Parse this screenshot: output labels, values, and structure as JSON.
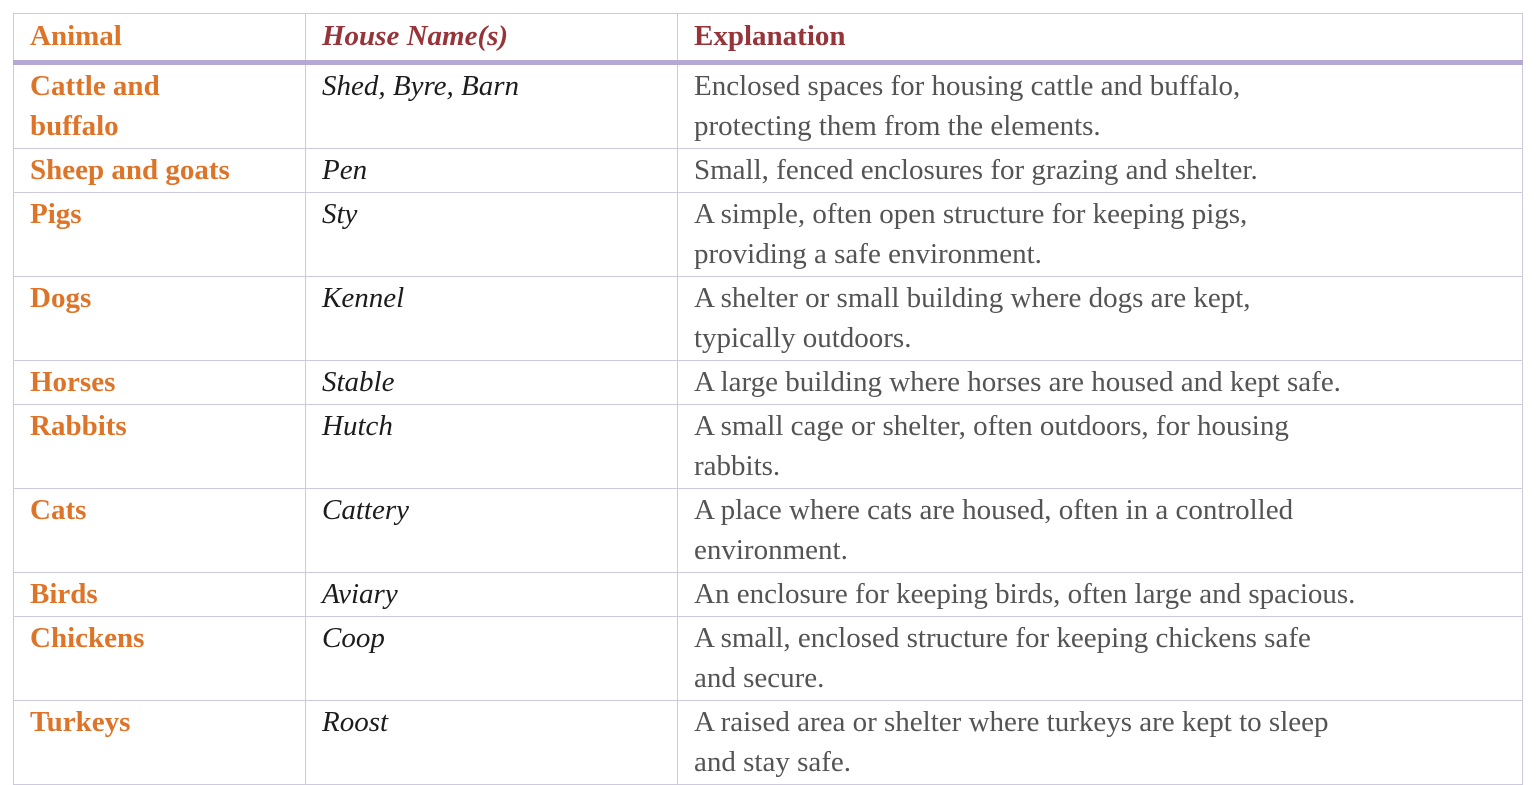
{
  "table": {
    "colors": {
      "animal_text": "#dd7428",
      "header_red": "#97343a",
      "house_text": "#1c1c1c",
      "explanation_text": "#545454",
      "grid_line": "#cfc9de",
      "header_rule": "#b6a8d4",
      "outer_border": "#c4bfd0",
      "page_bg": "#ffffff"
    },
    "columns": [
      {
        "id": "animal",
        "label": "Animal"
      },
      {
        "id": "house",
        "label": "House Name(s)"
      },
      {
        "id": "explanation",
        "label": "Explanation"
      }
    ],
    "rows": [
      {
        "animal": "Cattle and\nbuffalo",
        "house": "Shed, Byre, Barn",
        "explanation": "Enclosed spaces for housing cattle and buffalo,\nprotecting them from the elements."
      },
      {
        "animal": "Sheep and goats",
        "house": "Pen",
        "explanation": "Small, fenced enclosures for grazing and shelter."
      },
      {
        "animal": "Pigs",
        "house": "Sty",
        "explanation": "A simple, often open structure for keeping pigs,\nproviding a safe environment."
      },
      {
        "animal": "Dogs",
        "house": "Kennel",
        "explanation": "A shelter or small building where dogs are kept,\ntypically outdoors."
      },
      {
        "animal": "Horses",
        "house": "Stable",
        "explanation": "A large building where horses are housed and kept safe."
      },
      {
        "animal": "Rabbits",
        "house": "Hutch",
        "explanation": "A small cage or shelter, often outdoors, for housing\nrabbits."
      },
      {
        "animal": "Cats",
        "house": "Cattery",
        "explanation": "A place where cats are housed, often in a controlled\nenvironment."
      },
      {
        "animal": "Birds",
        "house": "Aviary",
        "explanation": "An enclosure for keeping birds, often large and spacious."
      },
      {
        "animal": "Chickens",
        "house": "Coop",
        "explanation": "A small, enclosed structure for keeping chickens safe\nand secure."
      },
      {
        "animal": "Turkeys",
        "house": "Roost",
        "explanation": "A raised area or shelter where turkeys are kept to sleep\nand stay safe."
      }
    ]
  }
}
